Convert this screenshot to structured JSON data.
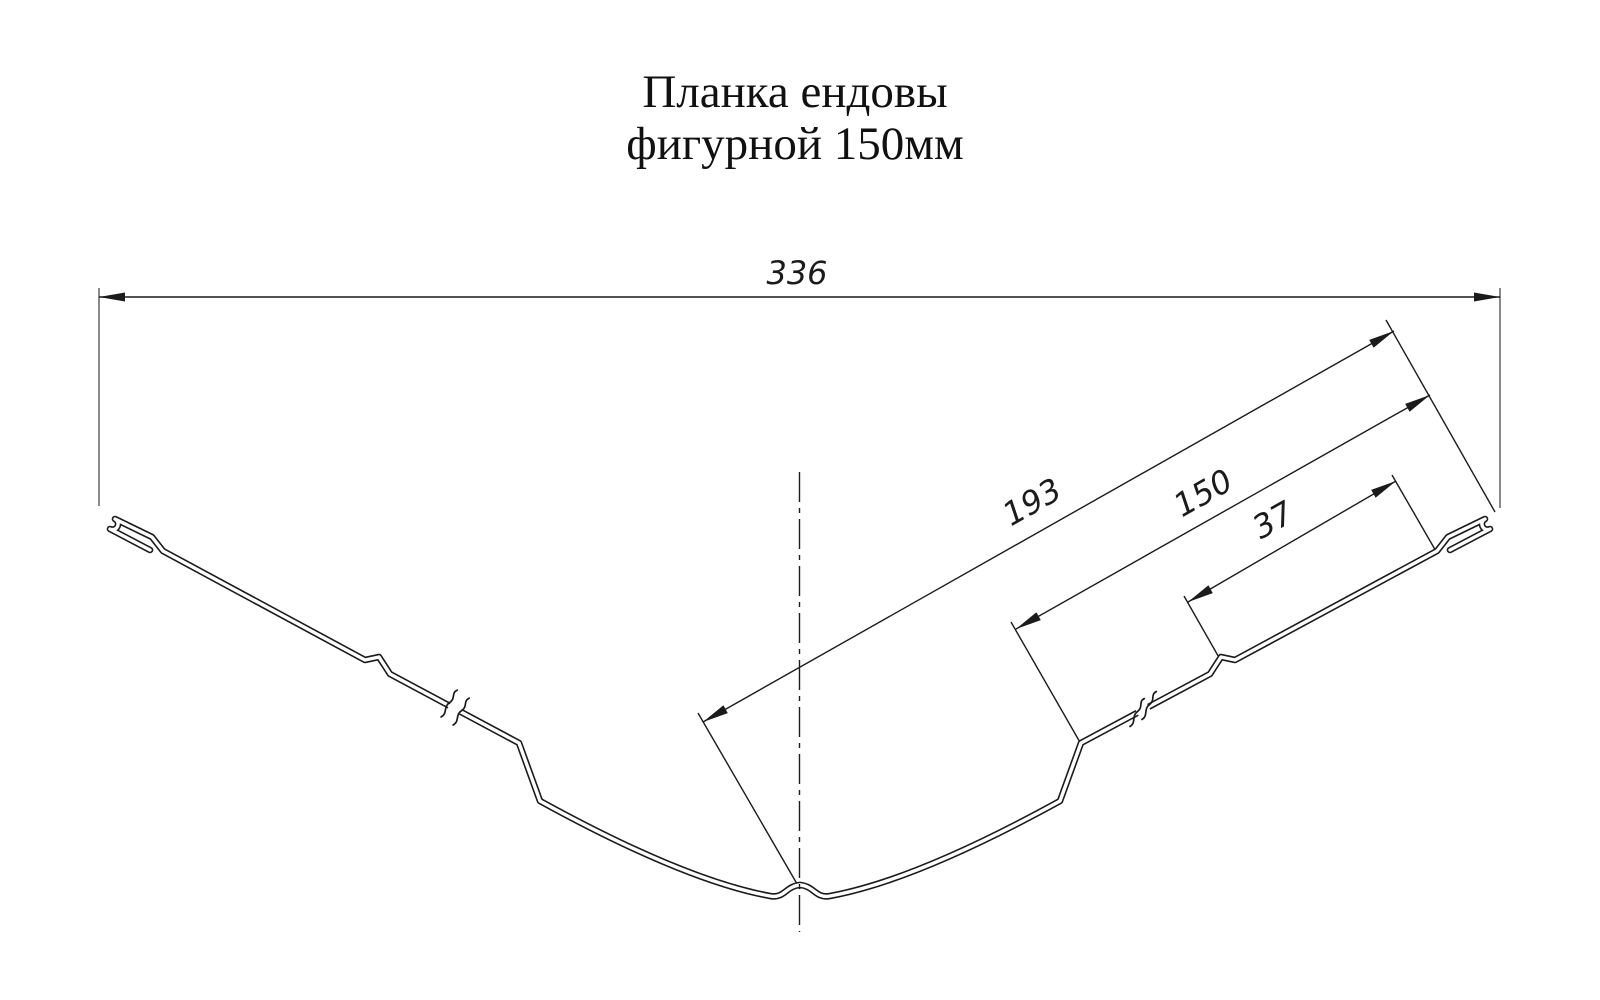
{
  "title": {
    "line1": "Планка ендовы",
    "line2": "фигурной 150мм"
  },
  "dims": {
    "overall": "336",
    "from_center": "193",
    "flange": "150",
    "edge": "37"
  },
  "colors": {
    "line": "#1b1b1b",
    "background": "#ffffff"
  }
}
